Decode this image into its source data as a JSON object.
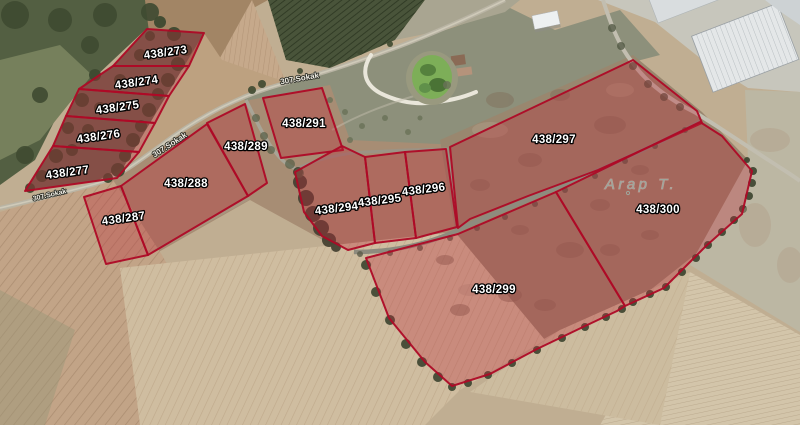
{
  "map": {
    "type": "satellite-cadastral-view",
    "place": {
      "text": "Arap T.",
      "x": 641,
      "y": 189,
      "rotation": 0
    },
    "street_labels": [
      {
        "text": "307.Sokak",
        "x": 50,
        "y": 197,
        "rotation": -13,
        "size": 7
      },
      {
        "text": "307.Sokak",
        "x": 171,
        "y": 147,
        "rotation": -33,
        "size": 8
      },
      {
        "text": "307.Sokak",
        "x": 300,
        "y": 81,
        "rotation": -10,
        "size": 8
      }
    ],
    "colors": {
      "parcel_fill": "#bb2736",
      "parcel_stroke": "#ae0a26",
      "parcel_label_fill": "#ffffff",
      "parcel_label_outline": "#000000",
      "place_label_color": "#9ea69c"
    },
    "parcels": [
      {
        "id": "438/273",
        "label": "438/273",
        "points": "147,29 204,33 189,66 113,66",
        "lx": 166,
        "ly": 56,
        "rot": -8
      },
      {
        "id": "438/274",
        "label": "438/274",
        "points": "113,66 189,66 169,96 79,89",
        "lx": 137,
        "ly": 86,
        "rot": -8
      },
      {
        "id": "438/275",
        "label": "438/275",
        "points": "79,89 169,96 155,123 66,116",
        "lx": 118,
        "ly": 111,
        "rot": -8
      },
      {
        "id": "438/276",
        "label": "438/276",
        "points": "66,116 155,123 139,152 53,146",
        "lx": 99,
        "ly": 140,
        "rot": -8
      },
      {
        "id": "438/277",
        "label": "438/277",
        "points": "53,146 139,152 117,178 25,191",
        "lx": 68,
        "ly": 176,
        "rot": -8
      },
      {
        "id": "438/287",
        "label": "438/287",
        "points": "84,197 121,186 148,255 106,264",
        "lx": 124,
        "ly": 222,
        "rot": -8
      },
      {
        "id": "438/288",
        "label": "438/288",
        "points": "121,186 207,124 248,196 148,255",
        "lx": 186,
        "ly": 187,
        "rot": 0
      },
      {
        "id": "438/289",
        "label": "438/289",
        "points": "207,123 245,104 267,183 248,196",
        "lx": 246,
        "ly": 150,
        "rot": 0
      },
      {
        "id": "438/291",
        "label": "438/291",
        "points": "263,98 322,88 343,150 281,158",
        "lx": 304,
        "ly": 127,
        "rot": 0
      },
      {
        "id": "438/294",
        "label": "438/294",
        "points": "295,172 342,146 365,157 375,243 348,250 322,236 304,212",
        "lx": 337,
        "ly": 212,
        "rot": -7
      },
      {
        "id": "438/295",
        "label": "438/295",
        "points": "365,157 405,152 416,238 375,243",
        "lx": 380,
        "ly": 204,
        "rot": -7
      },
      {
        "id": "438/296",
        "label": "438/296",
        "points": "405,152 446,149 457,227 416,238",
        "lx": 424,
        "ly": 193,
        "rot": -7
      },
      {
        "id": "438/297",
        "label": "438/297",
        "points": "450,147 633,60 697,111 702,123 598,170 528,196 470,219 458,228",
        "lx": 554,
        "ly": 143,
        "rot": 0
      },
      {
        "id": "438/299",
        "label": "438/299",
        "points": "366,258 458,234 556,192 625,306 617,311 583,327 537,349 490,374 452,386 425,362 389,318",
        "lx": 494,
        "ly": 293,
        "rot": 0
      },
      {
        "id": "438/300",
        "label": "438/300",
        "points": "556,192 700,122 722,136 752,171 742,214 706,246 664,288 625,306",
        "lx": 658,
        "ly": 213,
        "rot": 0
      }
    ]
  }
}
